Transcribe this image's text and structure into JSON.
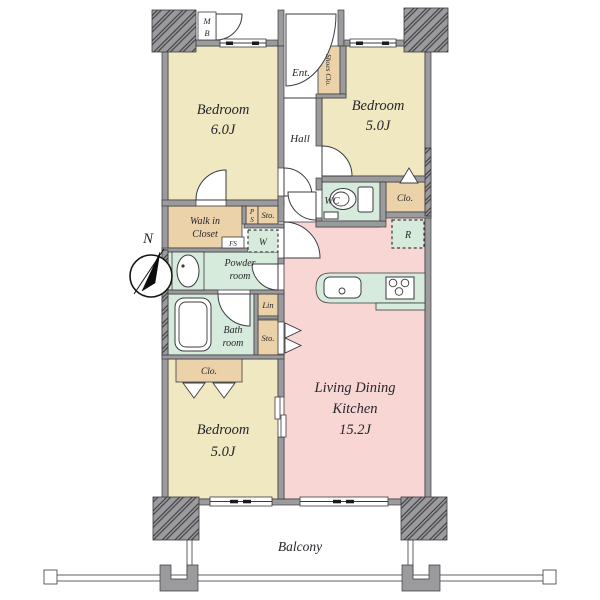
{
  "plan": {
    "compass_label": "N",
    "balcony_label": "Balcony",
    "entrance_label": "Ent.",
    "hall_label": "Hall",
    "rooms": {
      "bedroom1": {
        "name": "Bedroom",
        "size": "6.0J"
      },
      "bedroom2": {
        "name": "Bedroom",
        "size": "5.0J"
      },
      "bedroom3": {
        "name": "Bedroom",
        "size": "5.0J"
      },
      "ldk": {
        "name_line1": "Living Dining",
        "name_line2": "Kitchen",
        "size": "15.2J"
      },
      "walk_in_closet": {
        "line1": "Walk in",
        "line2": "Closet"
      },
      "powder_room": {
        "line1": "Powder",
        "line2": "room"
      },
      "bath_room": {
        "line1": "Bath",
        "line2": "room"
      },
      "wc": "WC"
    },
    "storage": {
      "shoes_closet": "Shoes Clo.",
      "closet_right": "Clo.",
      "closet_bottom": "Clo.",
      "storage_upper": "Sto.",
      "storage_lower": "Sto.",
      "linen": "Lin",
      "washer": "W",
      "fridge": "R",
      "free_space": "FS",
      "meter_box": {
        "line1": "M",
        "line2": "B"
      },
      "pipe_space": {
        "line1": "P",
        "line2": "S"
      }
    }
  },
  "colors": {
    "bedroom": "#f0e8c1",
    "ldk": "#f8d6d3",
    "wet": "#d6ebdc",
    "storage": "#ebd2a9",
    "wall": "#9b9b9d",
    "outline": "#3b3b40",
    "text": "#26262c",
    "bg": "#ffffff"
  }
}
